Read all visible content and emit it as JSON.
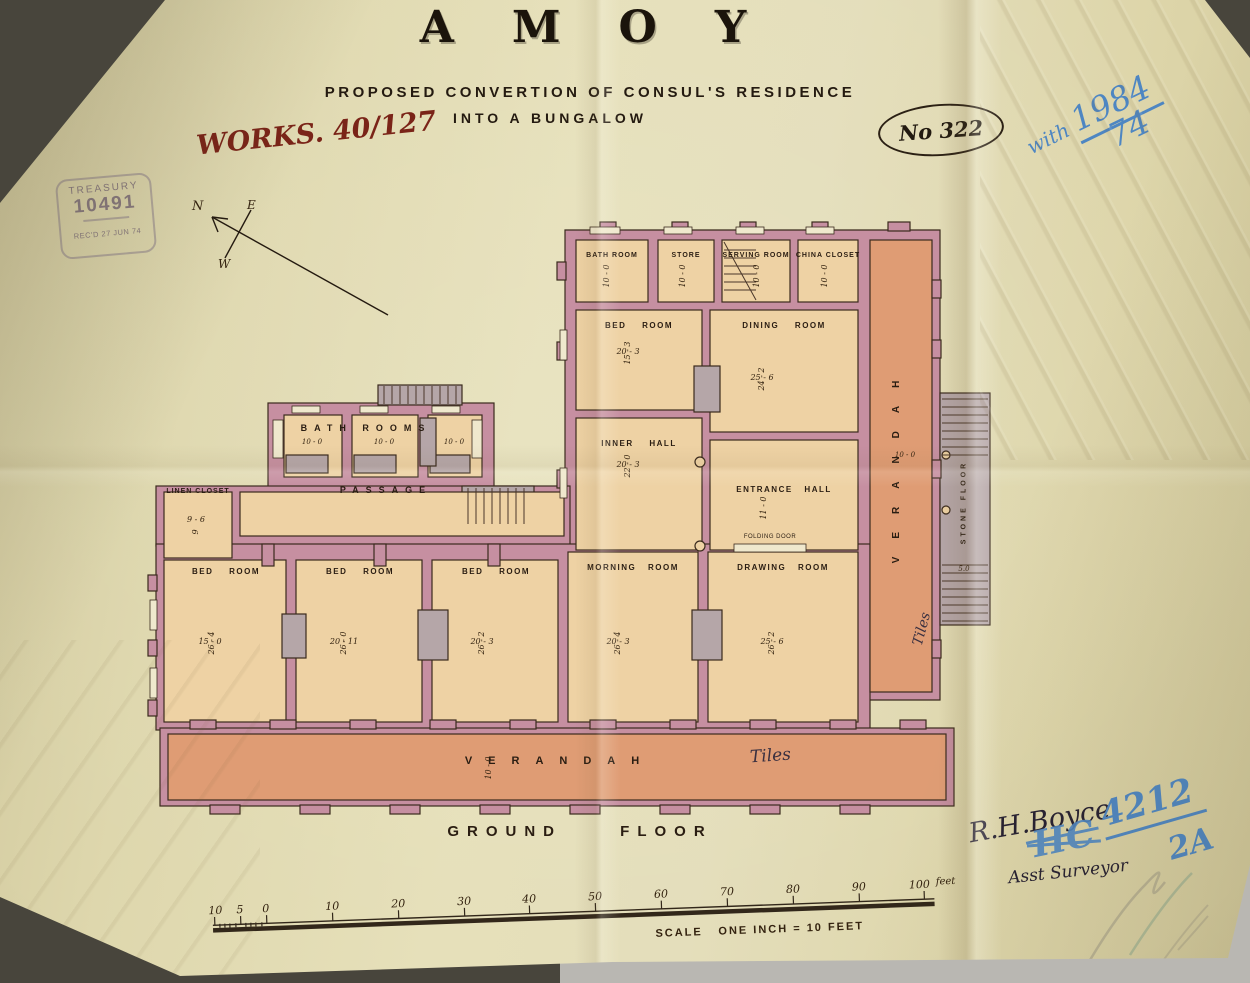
{
  "colors": {
    "paper": "#e3ddb5",
    "wall": "#c68fa1",
    "room": "#eed2a4",
    "verandah": "#df9c74",
    "stair": "#b5a6a8",
    "ink": "#2a1d12",
    "ink_blue": "#4e86c2",
    "ink_red": "#7a2418",
    "stamp_purple": "#8d7f8b"
  },
  "header": {
    "title": "AMOY",
    "subtitle1": "PROPOSED CONVERTION OF CONSUL'S RESIDENCE",
    "subtitle2": "INTO A BUNGALOW",
    "works_ref": "WORKS. 40/127",
    "plan_no": "No 322",
    "blue_ref_word": "with",
    "blue_ref_year": "1984",
    "blue_ref_num": "74"
  },
  "stamp": {
    "line1": "TREASURY",
    "line2": "10491",
    "line3": "REC'D 27 JUN 74"
  },
  "compass": {
    "n": "N",
    "e": "E",
    "w": "W"
  },
  "plan": {
    "tiles_note": "Tiles",
    "rooms": {
      "bath_top": {
        "label": "BATH ROOM",
        "dim_v": "10 - 0"
      },
      "store": {
        "label": "STORE",
        "dim_v": "10 - 0"
      },
      "serving": {
        "label": "SERVING ROOM",
        "dim_v": "10 - 0"
      },
      "china": {
        "label": "CHINA CLOSET",
        "dim_v": "10 - 0"
      },
      "bed_upper": {
        "label": "BED ROOM",
        "dim_h": "20 - 3",
        "dim_v": "15 - 3"
      },
      "dining": {
        "label": "DINING ROOM",
        "dim_h": "25 - 6",
        "dim_v": "24 - 2"
      },
      "inner_hall": {
        "label": "INNER HALL",
        "dim_h": "20 - 3",
        "dim_v": "22 - 0"
      },
      "entrance_hall": {
        "label": "ENTRANCE HALL",
        "dim_v": "11 - 0"
      },
      "folding_door": "FOLDING DOOR",
      "bath_wing": {
        "label": "BATH ROOMS",
        "dims": [
          "10 - 0",
          "10 - 0",
          "10 - 0"
        ]
      },
      "passage": {
        "label": "PASSAGE"
      },
      "linen": {
        "label": "LINEN CLOSET",
        "dim_h": "9 - 6",
        "dim_v": "9"
      },
      "bed1": {
        "label": "BED ROOM",
        "dim_h": "15 - 0",
        "dim_v": "26 - 4"
      },
      "bed2": {
        "label": "BED ROOM",
        "dim_h": "20 - 11",
        "dim_v": "26 - 0"
      },
      "bed3": {
        "label": "BED ROOM",
        "dim_h": "20 - 3",
        "dim_v": "26 - 2"
      },
      "morning": {
        "label": "MORNING ROOM",
        "dim_h": "20 - 3",
        "dim_v": "26 - 4"
      },
      "drawing": {
        "label": "DRAWING ROOM",
        "dim_h": "25 - 6",
        "dim_v": "26 - 2"
      },
      "verandah_right": {
        "label": "VERANDAH",
        "dim": "10 - 0"
      },
      "stone_floor": {
        "label": "STONE FLOOR",
        "dim": "5.0"
      },
      "verandah_bottom": {
        "label": "VERANDAH",
        "dim_v": "10 - 0"
      }
    }
  },
  "footer": {
    "floor_label": "GROUND FLOOR"
  },
  "scale_bar": {
    "ticks": [
      "10",
      "5",
      "0",
      "10",
      "20",
      "30",
      "40",
      "50",
      "60",
      "70",
      "80",
      "90",
      "100"
    ],
    "unit": "feet",
    "caption_left": "SCALE",
    "caption_right": "ONE INCH = 10 FEET"
  },
  "annotations": {
    "signature_ink": "R.H.Boyce",
    "signature_ink2": "Asst Surveyor",
    "blue_crossed": "HC",
    "blue_number": "4212",
    "blue_suffix": "2A"
  }
}
